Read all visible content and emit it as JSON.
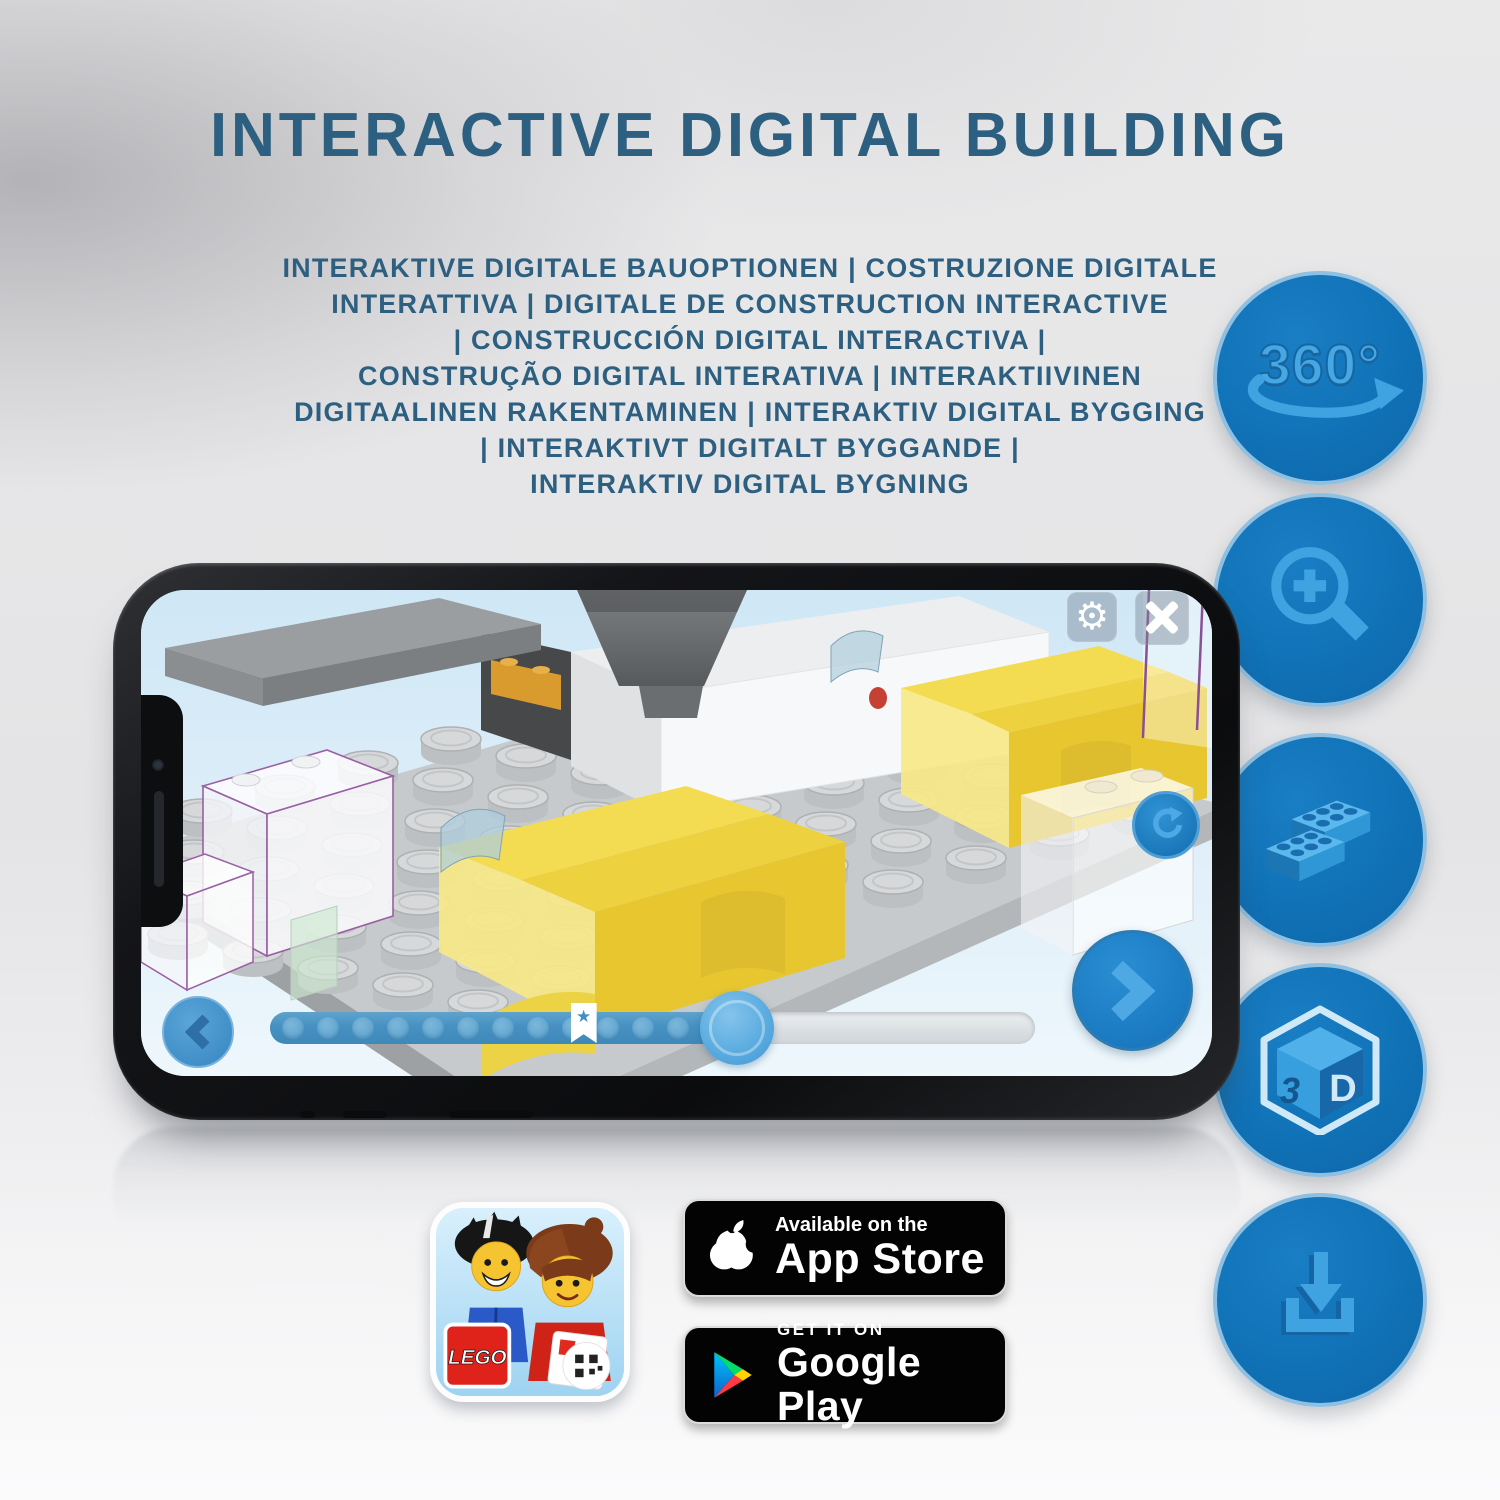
{
  "title": "INTERACTIVE DIGITAL BUILDING",
  "subtitle_lines": [
    "INTERAKTIVE DIGITALE BAUOPTIONEN | COSTRUZIONE DIGITALE",
    "INTERATTIVA | DIGITALE DE CONSTRUCTION INTERACTIVE",
    "| CONSTRUCCIÓN DIGITAL INTERACTIVA |",
    "CONSTRUÇÃO DIGITAL INTERATIVA | INTERAKTIIVINEN",
    "DIGITAALINEN RAKENTAMINEN | INTERAKTIV DIGITAL BYGGING",
    "| INTERAKTIVT DIGITALT BYGGANDE |",
    "INTERAKTIV DIGITAL BYGNING"
  ],
  "feature_icons": {
    "rotate_label": "360°",
    "cube_left": "3",
    "cube_right": "D",
    "items": [
      "360-rotation",
      "zoom-in",
      "lego-bricks",
      "3d-view",
      "download"
    ]
  },
  "phone_app": {
    "progress_percent": 61,
    "bookmark_percent": 41,
    "progress_dots": 13
  },
  "store": {
    "app_store_tagline": "Available on the",
    "app_store_name": "App Store",
    "google_play_tagline": "GET IT ON",
    "google_play_name": "Google Play",
    "app_icon_logo": "LEGO"
  },
  "colors": {
    "heading": "#2d5f81",
    "icon_circle": "#1173b8",
    "icon_glyph": "#3fa3e2",
    "brick_yellow": "#e7c630",
    "app_accent": "#1f7ec6"
  }
}
